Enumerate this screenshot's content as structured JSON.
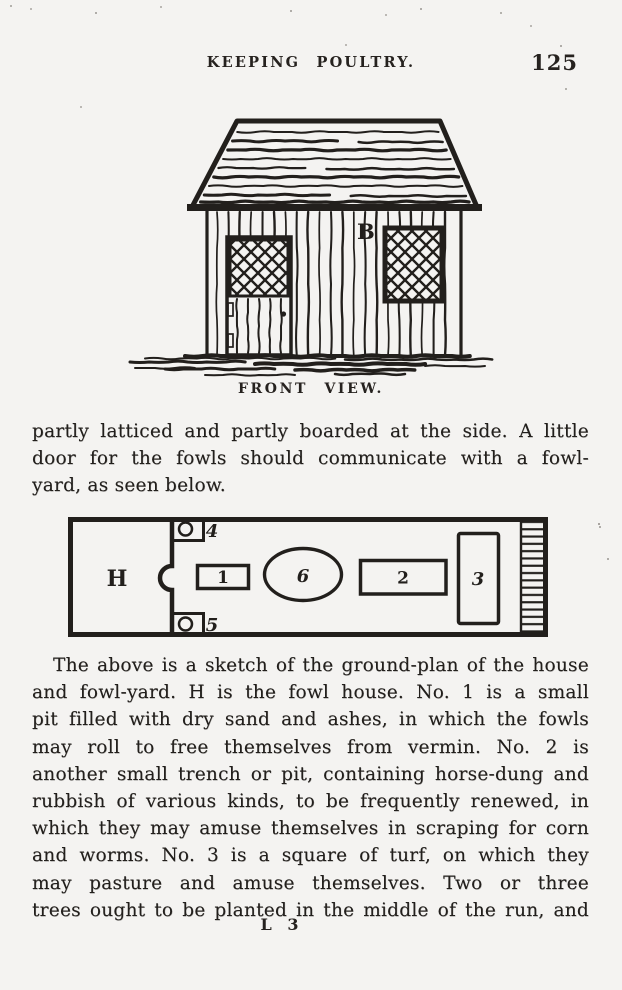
{
  "header": {
    "title": "KEEPING POULTRY.",
    "page_number": "125"
  },
  "figure_front_view": {
    "building_label": "B",
    "caption": "FRONT VIEW."
  },
  "paragraph_1": {
    "lines": [
      "partly latticed and partly boarded at the side.  A little",
      "door for the fowls should communicate with a fowl-",
      "yard, as seen below."
    ]
  },
  "figure_ground_plan": {
    "labels": {
      "house": "H",
      "item1": "1",
      "item2": "2",
      "item3": "3",
      "item4": "4",
      "item5": "5",
      "item6": "6"
    }
  },
  "paragraph_2": {
    "lines": [
      "The above is a sketch of the ground-plan of the house",
      "and fowl-yard.  H is the fowl house.  No. 1 is a small",
      "pit filled with dry sand and ashes, in which the fowls",
      "may roll to free themselves from vermin.  No. 2 is",
      "another small trench or pit, containing horse-dung and",
      "rubbish of various kinds, to be frequently renewed, in",
      "which they may amuse themselves in scraping for corn",
      "and worms.  No. 3 is a square of turf, on which they",
      "may pasture and amuse themselves.  Two or three",
      "trees ought to be planted in the middle of the run, and"
    ]
  },
  "footer": {
    "signature_mark": "L 3"
  },
  "colors": {
    "ink": "#221f1c",
    "paper": "#f4f3f1"
  }
}
